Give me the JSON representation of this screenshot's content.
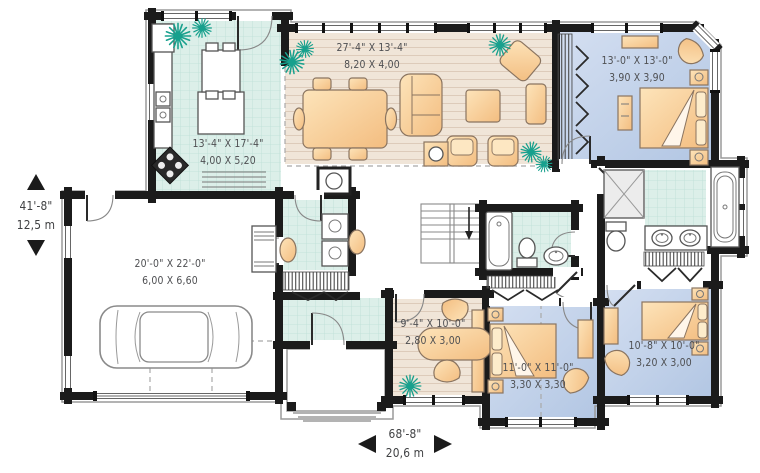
{
  "plan": {
    "rooms": {
      "great_room": {
        "imperial": "27'-4\" X 13'-4\"",
        "metric": "8,20 X 4,00"
      },
      "kitchen": {
        "imperial": "13'-4\" X 17'-4\"",
        "metric": "4,00 X 5,20"
      },
      "bedroom_top_right": {
        "imperial": "13'-0\" X 13'-0\"",
        "metric": "3,90 X 3,90"
      },
      "garage": {
        "imperial": "20'-0\" X 22'-0\"",
        "metric": "6,00 X 6,60"
      },
      "office": {
        "imperial": "9'-4\" X 10'-0\"",
        "metric": "2,80 X 3,00"
      },
      "bedroom_bottom_middle": {
        "imperial": "11'-0\" X 11'-0\"",
        "metric": "3,30 X 3,30"
      },
      "bedroom_bottom_right": {
        "imperial": "10'-8\" X 10'-0\"",
        "metric": "3,20 X 3,00"
      }
    },
    "overall": {
      "depth": {
        "imperial": "41'-8\"",
        "metric": "12,5 m"
      },
      "width": {
        "imperial": "68'-8\"",
        "metric": "20,6 m"
      }
    },
    "colors": {
      "wall": "#1b1b1b",
      "wood_floor": "#efe2d4",
      "tile_floor": "#d9ece6",
      "bedroom_floor": "#c3d4ea",
      "furniture": "#f7cf9a",
      "fixture": "#ffffff",
      "plant": "#17a08d",
      "label_text": "#4e4f52",
      "trim": "#9a9a9a"
    }
  }
}
